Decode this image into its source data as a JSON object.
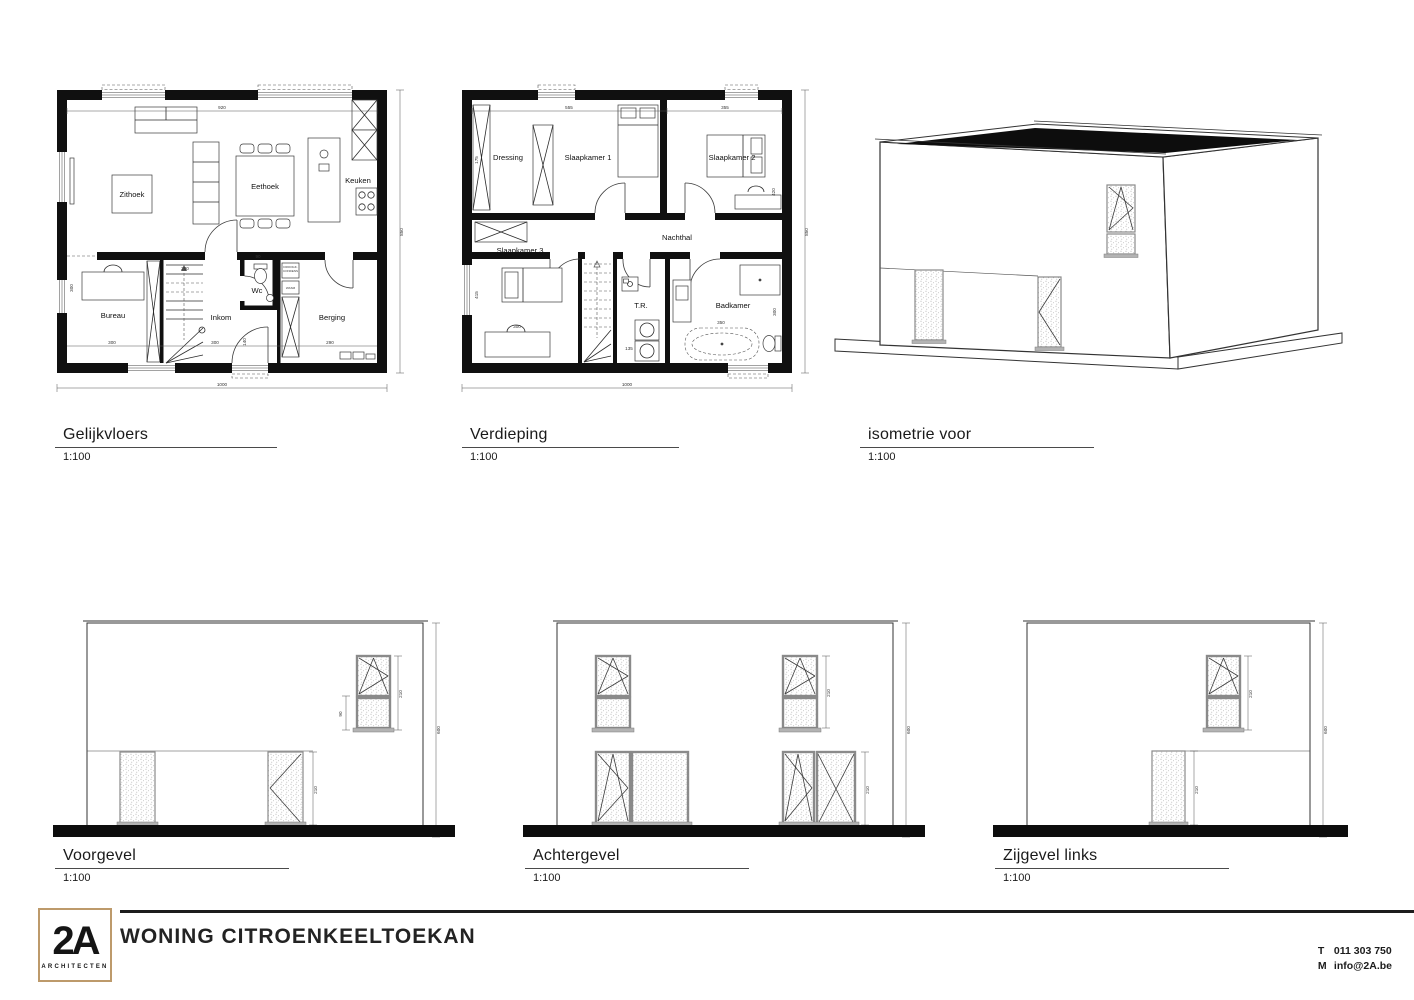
{
  "drawings": {
    "gelijkvloers": {
      "title": "Gelijkvloers",
      "scale": "1:100",
      "rooms": {
        "zithoek": "Zithoek",
        "eethoek": "Eethoek",
        "keuken": "Keuken",
        "bureau": "Bureau",
        "inkom": "Inkom",
        "wc": "Wc",
        "berging": "Berging"
      },
      "labels": {
        "droogk": "DROOGK.",
        "condens": "CONDENS",
        "wasm": "WASM"
      },
      "dims": {
        "top": "920",
        "right": "850",
        "bottom": "1000",
        "bureau_width": "300",
        "inkom_width": "300",
        "berging_width": "290",
        "stair_width": "200",
        "bureau_left": "300",
        "hal_height": "140",
        "wc_width": "90"
      }
    },
    "verdieping": {
      "title": "Verdieping",
      "scale": "1:100",
      "rooms": {
        "dressing": "Dressing",
        "slaapkamer1": "Slaapkamer 1",
        "slaapkamer2": "Slaapkamer 2",
        "slaapkamer3": "Slaapkamer 3",
        "nachthal": "Nachthal",
        "tr": "T.R.",
        "badkamer": "Badkamer"
      },
      "dims": {
        "top_left": "555",
        "top_right": "355",
        "right": "850",
        "bottom": "1000",
        "left_top": "175",
        "left_bottom": "415",
        "slk3_width": "300",
        "tr_width": "135",
        "bad_width": "350",
        "bad_right": "300",
        "slk2_right": "420"
      }
    },
    "isometrie": {
      "title": "isometrie voor",
      "scale": "1:100"
    },
    "voorgevel": {
      "title": "Voorgevel",
      "scale": "1:100",
      "dims": {
        "window": "210",
        "borstwering": "90",
        "door": "210",
        "height": "600"
      }
    },
    "achtergevel": {
      "title": "Achtergevel",
      "scale": "1:100",
      "dims": {
        "upper": "210",
        "lower": "210",
        "height": "600"
      }
    },
    "zijgevel": {
      "title": "Zijgevel links",
      "scale": "1:100",
      "dims": {
        "upper": "210",
        "lower": "210",
        "height": "600"
      }
    }
  },
  "footer": {
    "logo_main": "2A",
    "logo_sub": "ARCHITECTEN",
    "project_title": "WONING CITROENKEELTOEKAN",
    "phone_label": "T",
    "phone": "011 303 750",
    "email_label": "M",
    "email": "info@2A.be"
  },
  "colors": {
    "line": "#1a1a1a",
    "accent_gold": "#bd9a6b",
    "wall": "#101010"
  }
}
